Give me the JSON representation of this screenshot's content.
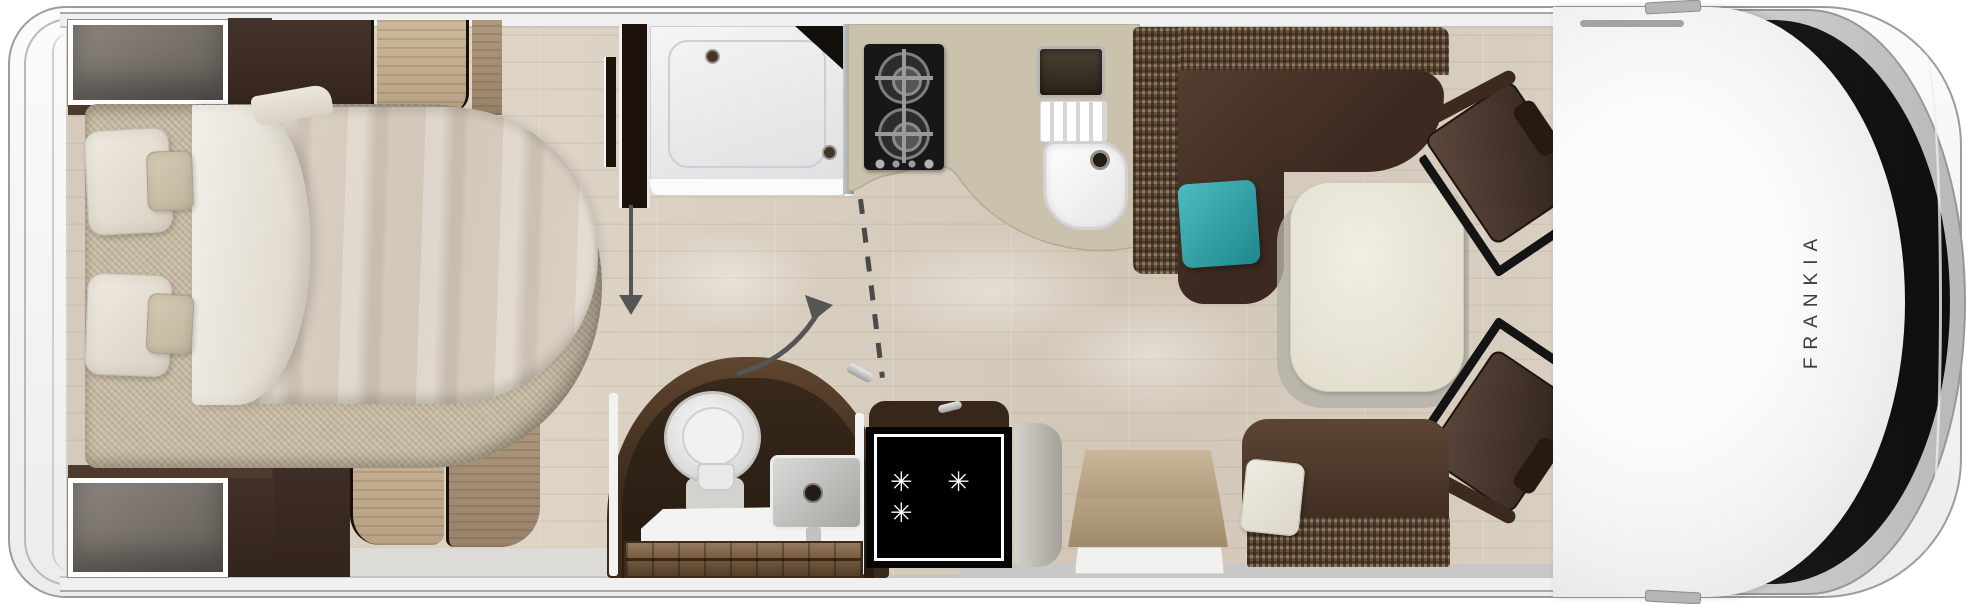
{
  "floorplan": {
    "brand_label": "FRANKIA",
    "fridge_symbol": "✳ ✳ ✳"
  },
  "icons": {
    "fridge_symbol_meaning": "freezer-stars-icon",
    "door_swing": "curved-arrow-icon",
    "slide_direction": "down-arrow-icon",
    "partition": "dashed-line"
  },
  "colors": {
    "wall": "#f0f0f0",
    "floor": "#d8cec0",
    "mattress": "#c8bca5",
    "weave_brown": "#65523f",
    "appliance_black": "#171717",
    "chair_brown": "#463228",
    "fridge_black": "#060606",
    "teal_cushion": "#2fa3a8",
    "arrow_gray": "#555555",
    "brand_text": "#3e3e3e"
  }
}
